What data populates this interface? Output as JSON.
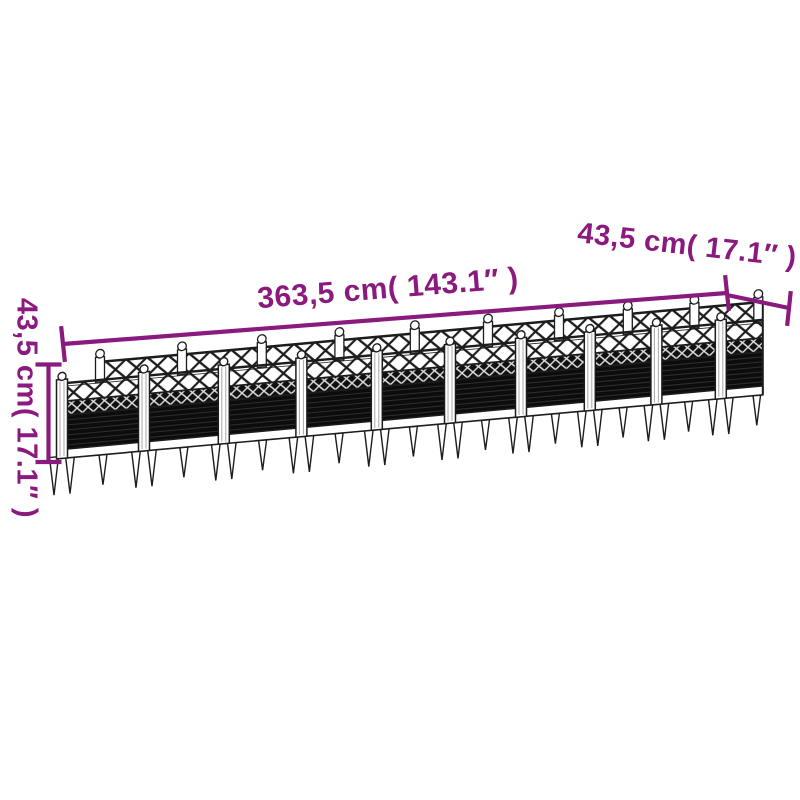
{
  "annotations": {
    "length_label": "363,5 cm( 143.1″ )",
    "depth_label": "43,5 cm( 17.1″ )",
    "height_label": "43,5 cm( 17.1″ )"
  },
  "colors": {
    "annotation": "#8a1a7d",
    "line_art": "#1c1c1c",
    "panel": "#0c0c0c",
    "background": "#ffffff"
  },
  "illustration": {
    "subject": "garden planter with trellis and ground spikes",
    "bays": 9
  }
}
